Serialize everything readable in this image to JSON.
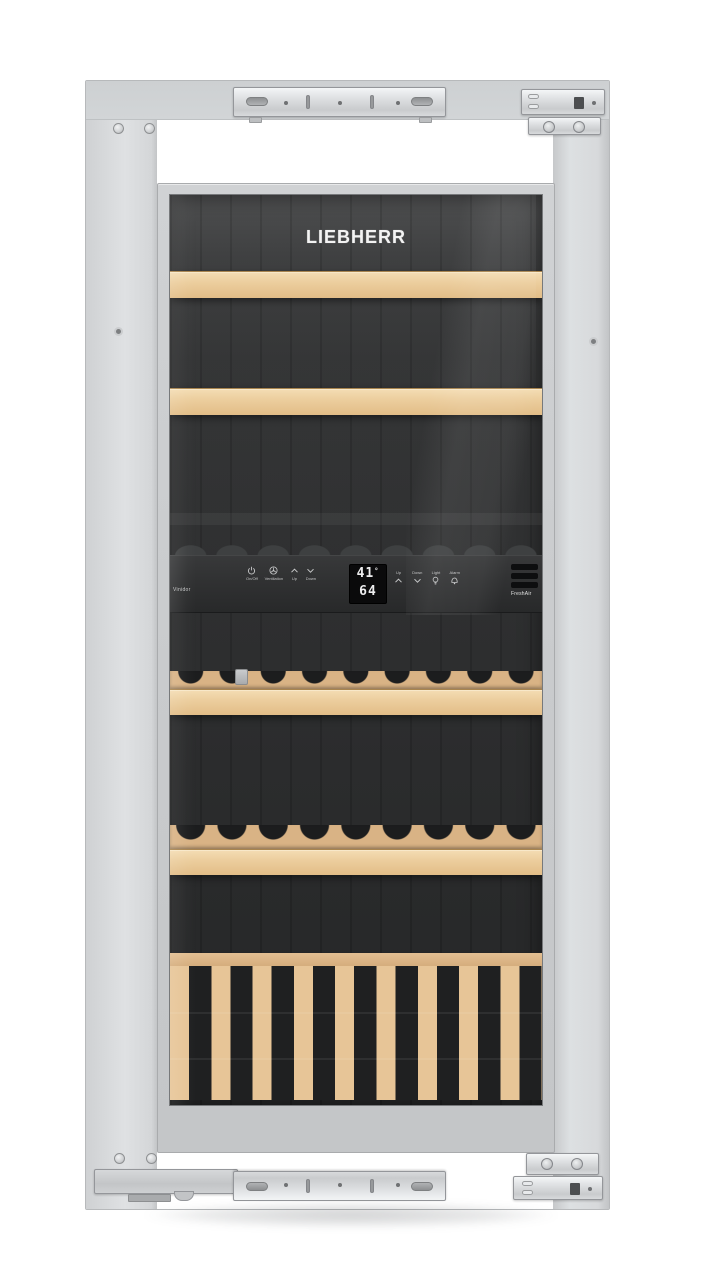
{
  "brand": {
    "logo_text": "LIEBHERR",
    "series_label": "Vinidor",
    "freshair_label": "FreshAir"
  },
  "display": {
    "upper_zone_temp": "41",
    "degree_mark": "°",
    "lower_zone_temp": "64"
  },
  "upper_zone_controls": {
    "buttons": [
      {
        "name": "power",
        "label": "On/Off"
      },
      {
        "name": "ventilation",
        "label": "Ventilation"
      },
      {
        "name": "up",
        "label": "Up"
      },
      {
        "name": "down",
        "label": "Down"
      }
    ]
  },
  "lower_zone_controls": {
    "buttons": [
      {
        "name": "up",
        "label": "Up"
      },
      {
        "name": "down",
        "label": "Down"
      },
      {
        "name": "light",
        "label": "Light"
      },
      {
        "name": "alarm",
        "label": "Alarm"
      }
    ]
  },
  "colors": {
    "background": "#ffffff",
    "cabinet_frame": "#d8dadc",
    "door_glass_dark": "#2c2d2e",
    "wood_shelf": "#ecce9e",
    "control_panel": "#313233",
    "display_digits": "#ededee"
  }
}
